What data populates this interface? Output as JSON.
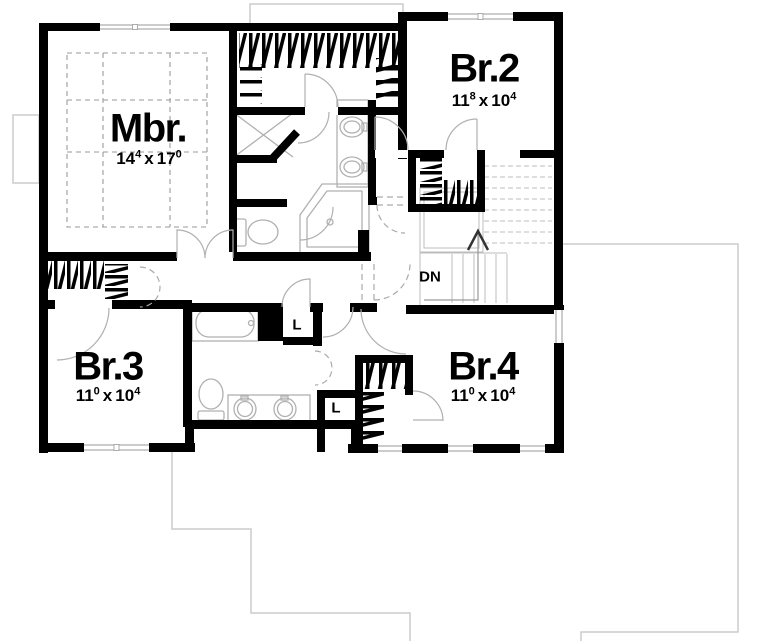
{
  "plan": {
    "rooms": [
      {
        "id": "mbr",
        "label": "Mbr.",
        "dim": {
          "ft1": "14",
          "in1": "4",
          "sep": "x",
          "ft2": "17",
          "in2": "0"
        }
      },
      {
        "id": "br2",
        "label": "Br.2",
        "dim": {
          "ft1": "11",
          "in1": "8",
          "sep": "x",
          "ft2": "10",
          "in2": "4"
        }
      },
      {
        "id": "br3",
        "label": "Br.3",
        "dim": {
          "ft1": "11",
          "in1": "0",
          "sep": "x",
          "ft2": "10",
          "in2": "4"
        }
      },
      {
        "id": "br4",
        "label": "Br.4",
        "dim": {
          "ft1": "11",
          "in1": "0",
          "sep": "x",
          "ft2": "10",
          "in2": "4"
        }
      }
    ],
    "annotations": {
      "stairs": "DN",
      "linen_upper": "L",
      "linen_lower": "L"
    },
    "colors": {
      "wall": "#000000",
      "fixture_line": "#b0b0b0",
      "roof_line": "#cccccc",
      "dashed_line": "#999999",
      "text": "#000000"
    }
  }
}
